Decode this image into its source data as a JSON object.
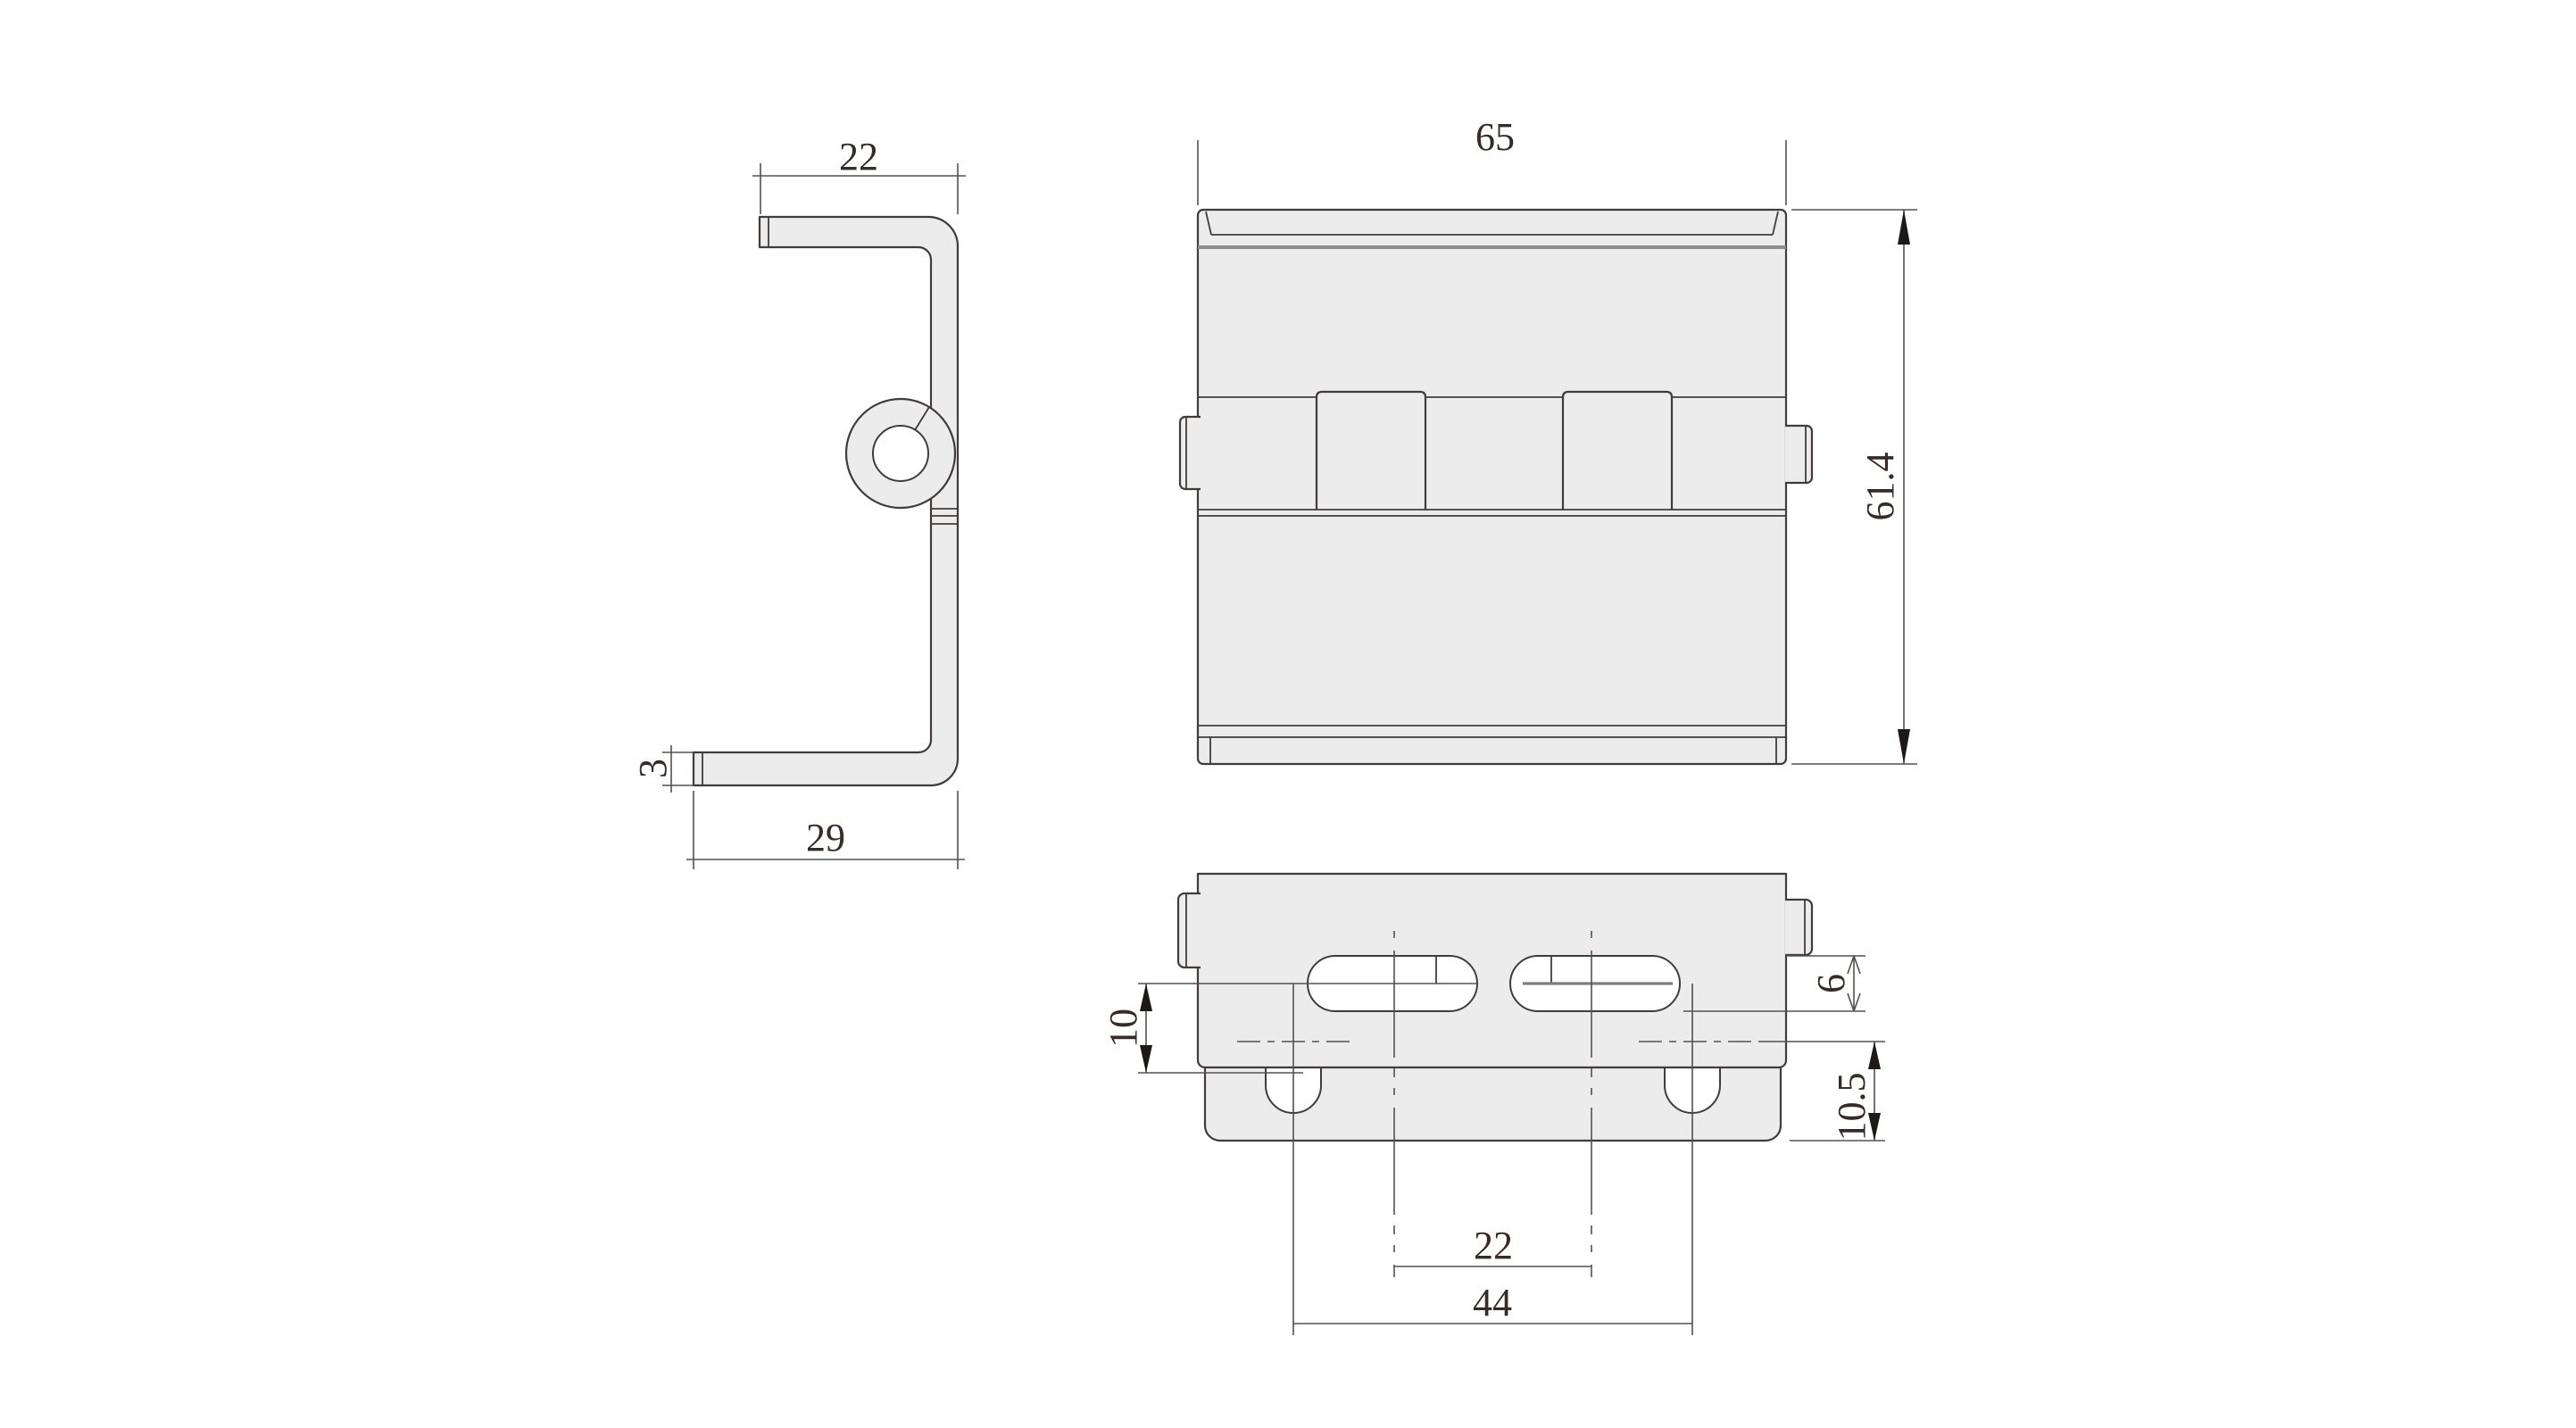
{
  "drawing_type": "engineering-drawing-hinge",
  "dimensions": {
    "side_flange_width": "22",
    "side_thickness": "3",
    "side_base_width": "29",
    "front_width": "65",
    "front_height": "61.4",
    "slot_center_offset": "10",
    "slot_width": "6",
    "axis_to_edge": "10.5",
    "slot_spacing": "22",
    "notch_spacing": "44"
  },
  "colors": {
    "background": "#ffffff",
    "part_fill": "#ececec",
    "outline": "#413c3a",
    "dimension_line": "#55504e",
    "shadow_line": "#8c8c8c",
    "text": "#362b26",
    "arrow": "#1c1917"
  }
}
